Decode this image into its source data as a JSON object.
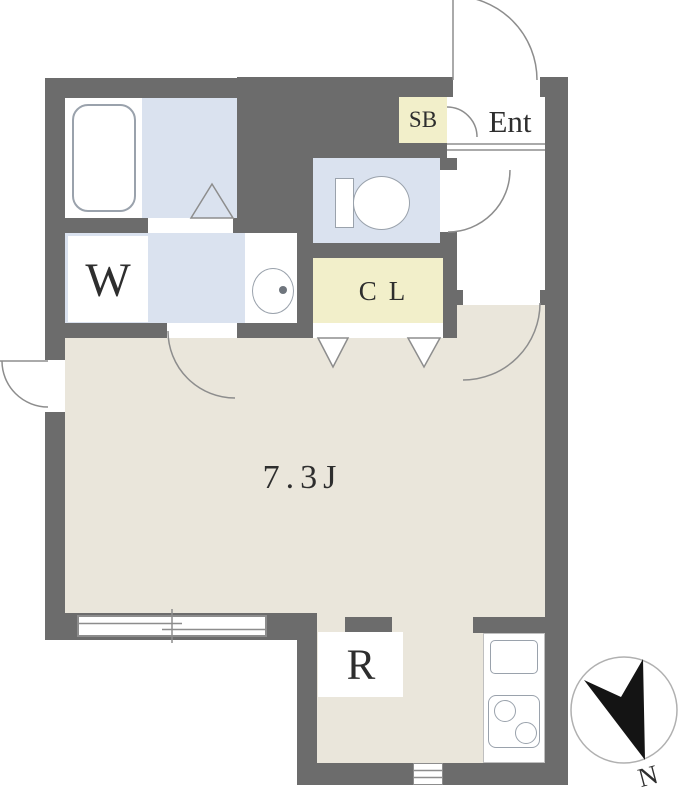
{
  "title": "Apartment floor plan, 7.3 tatami studio",
  "labels": {
    "shoe_box": "SB",
    "entrance": "Ent",
    "closet": "CL",
    "washer_room": "W",
    "main_room": "7.3J",
    "refrigerator": "R",
    "compass_north": "N"
  },
  "colors": {
    "wall": "#6c6c6c",
    "floor-main": "#eae6db",
    "floor-wet": "#dae2ef",
    "floor-storage": "#f2efca",
    "floor-white": "#ffffff",
    "line": "#8d8d8d",
    "fixture-border": "#9aa2ac",
    "text": "#2e2e2e",
    "needle": "#141414"
  }
}
